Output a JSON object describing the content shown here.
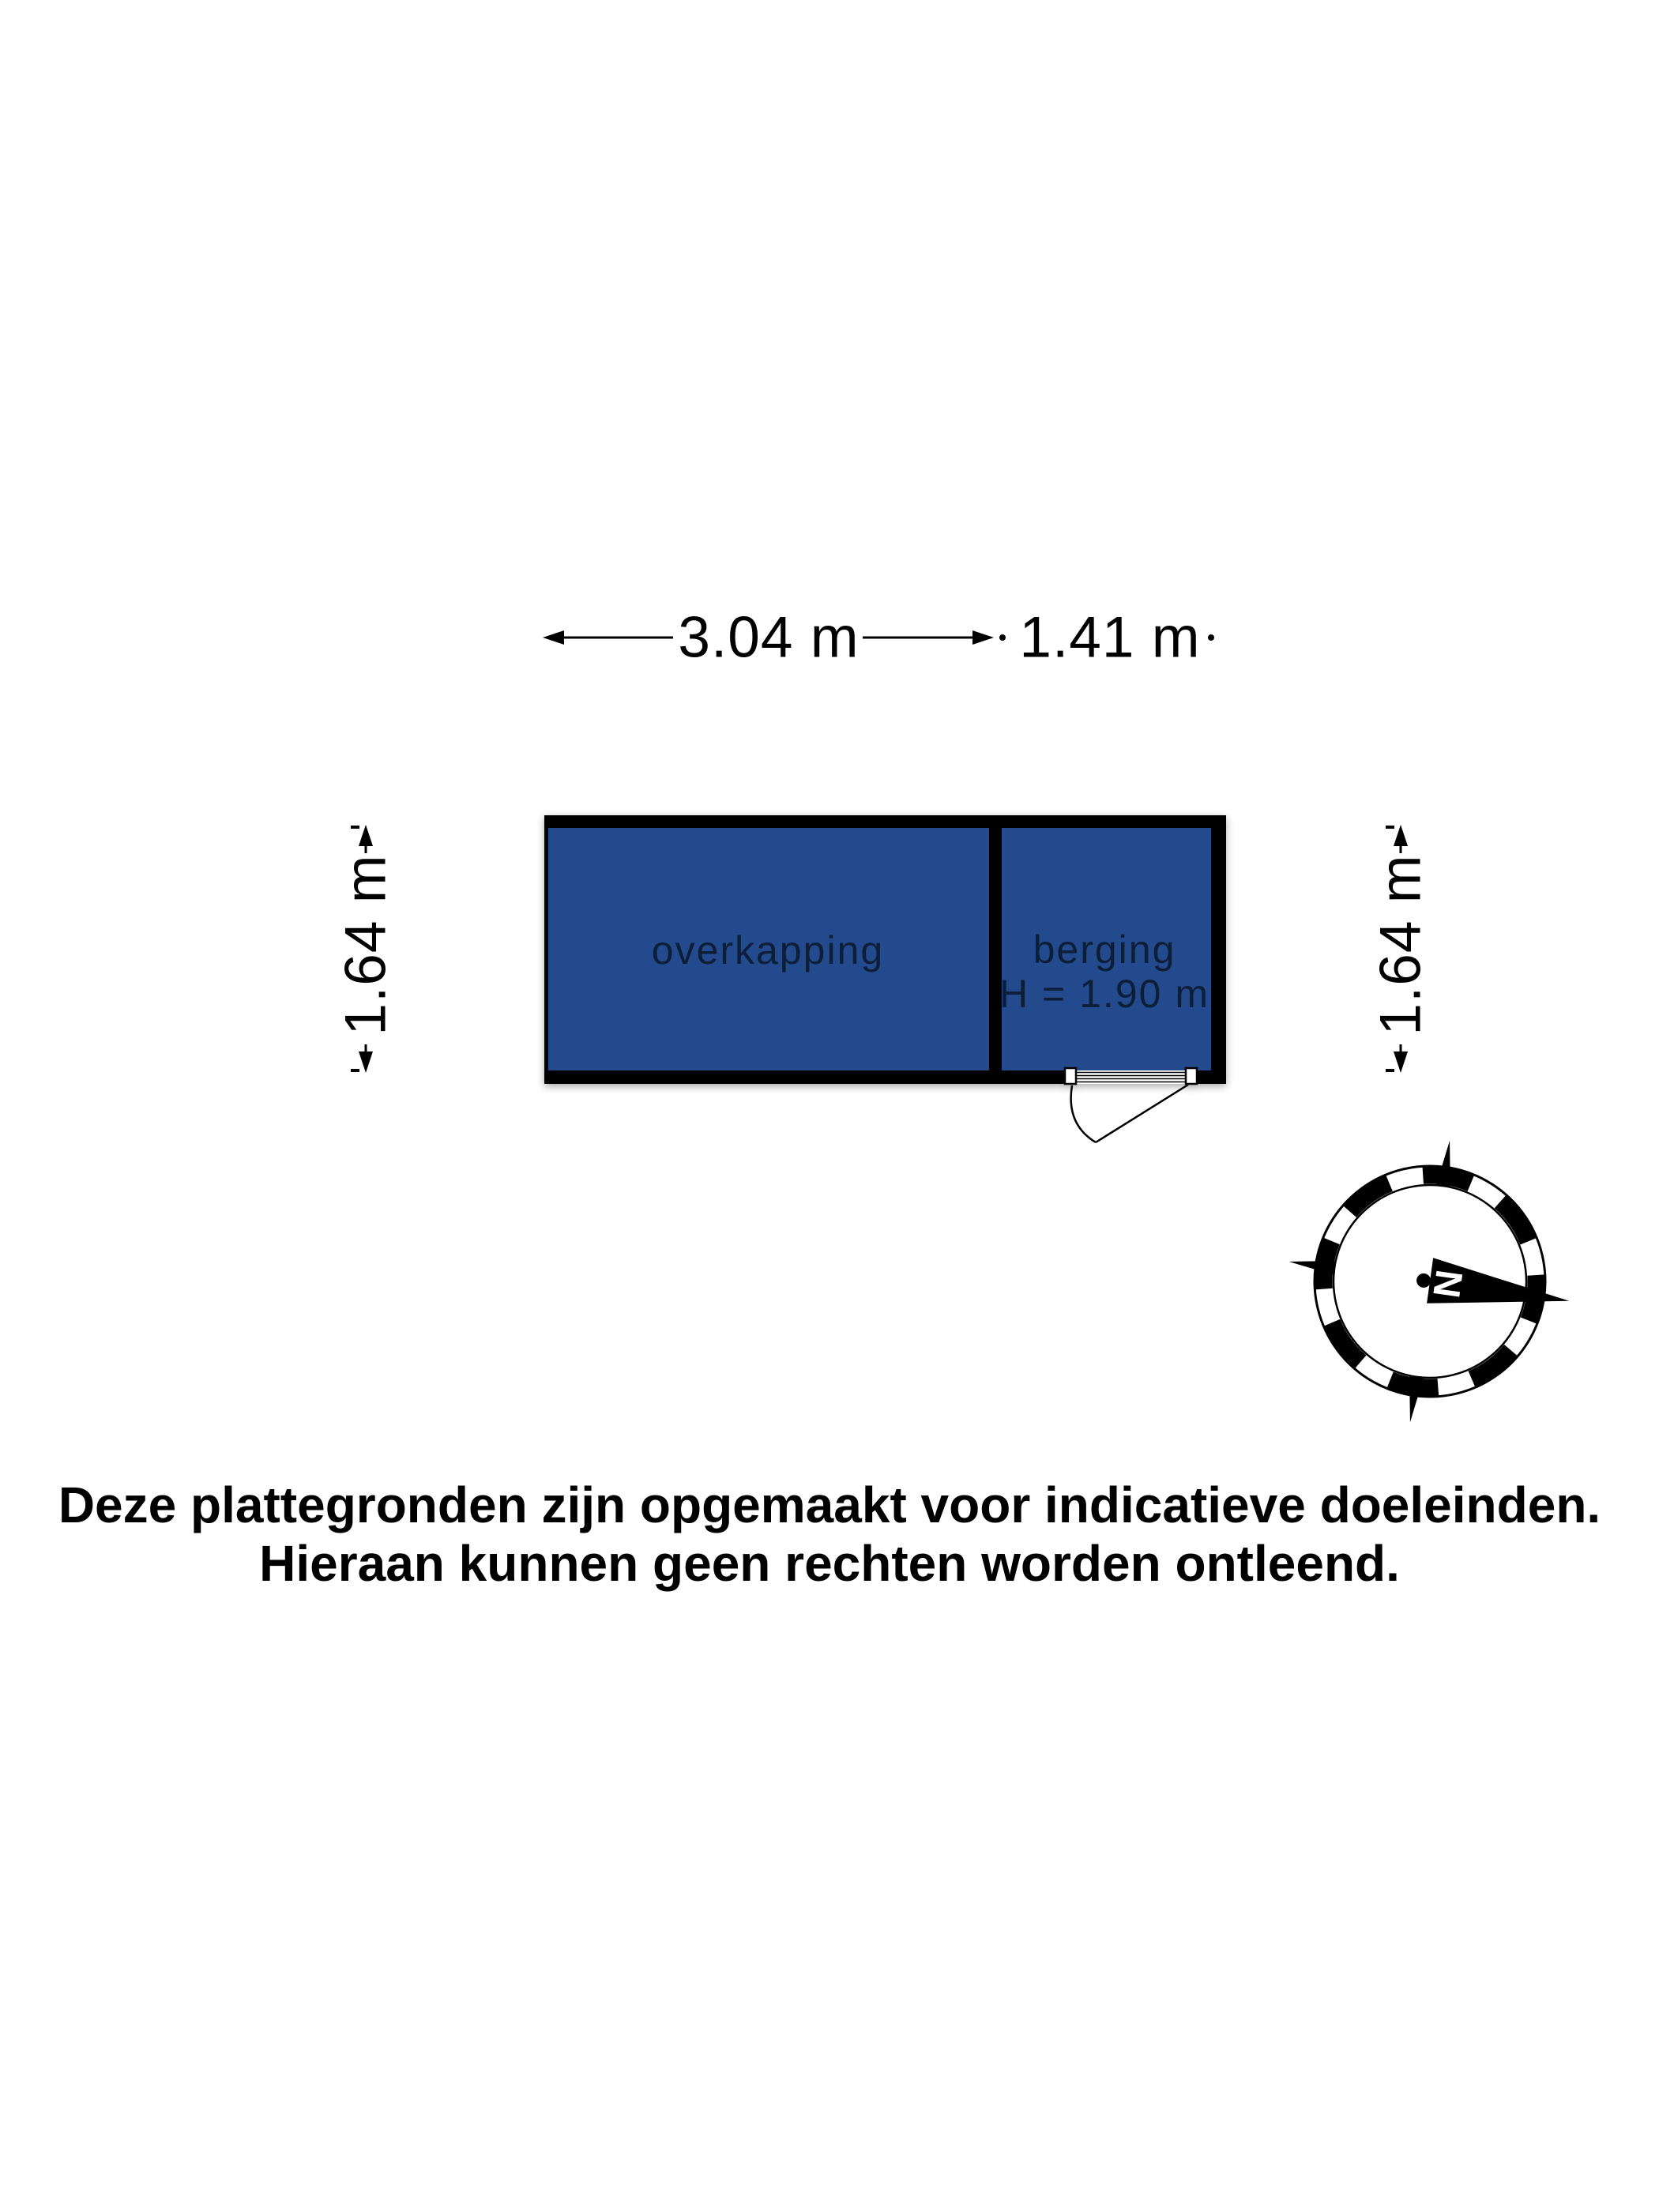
{
  "dimensions": {
    "top_left": "3.04 m",
    "top_right": "1.41 m",
    "side_left": "1.64 m",
    "side_right": "1.64 m"
  },
  "rooms": {
    "overkapping": {
      "label": "overkapping"
    },
    "berging": {
      "label": "berging",
      "height_note": "H = 1.90 m"
    }
  },
  "compass": {
    "north": "N"
  },
  "disclaimer": {
    "line1": "Deze plattegronden zijn opgemaakt voor indicatieve doeleinden.",
    "line2": "Hieraan kunnen geen rechten worden ontleend."
  },
  "colors": {
    "room_fill": "#224A8C",
    "wall": "#000000",
    "room_text": "#0C1E38",
    "text": "#000000",
    "background": "#FFFFFF"
  }
}
